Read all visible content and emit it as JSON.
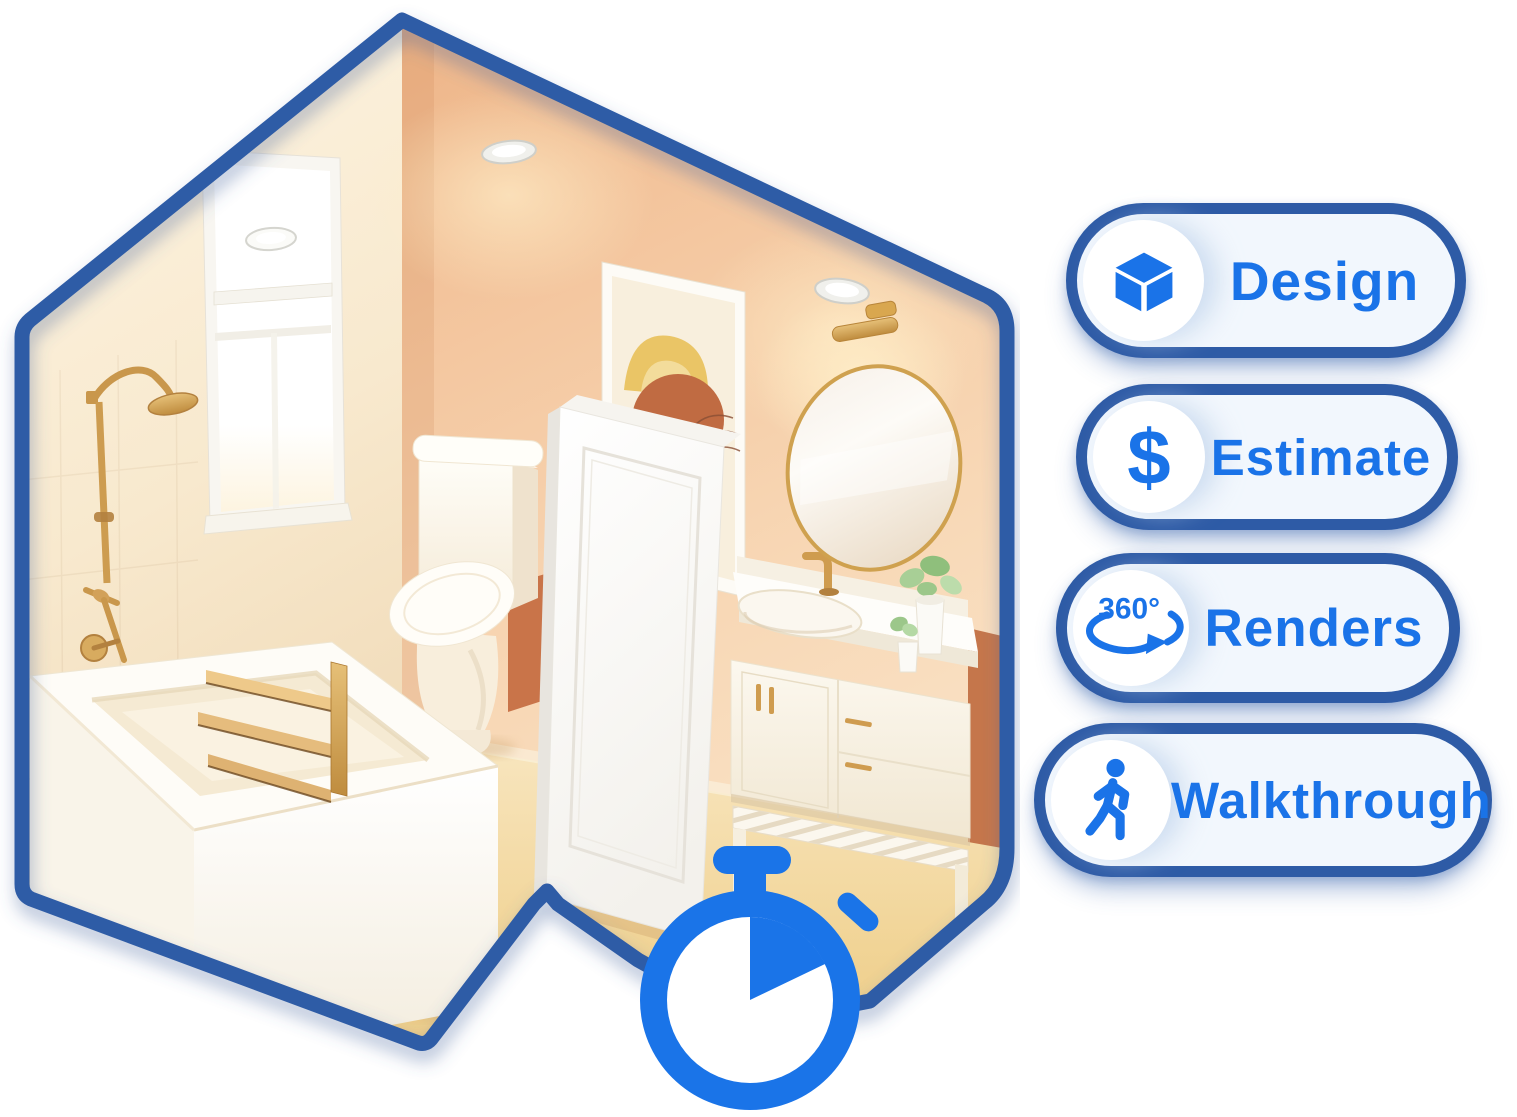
{
  "hero": {
    "feature_buttons": [
      {
        "label": "Design",
        "icon": "cube-3d-icon"
      },
      {
        "label": "Estimate",
        "icon": "dollar-sign-icon",
        "icon_text": "$"
      },
      {
        "label": "Renders",
        "icon": "rotation-360-icon",
        "icon_text": "360°"
      },
      {
        "label": "Walkthrough",
        "icon": "person-walking-icon"
      }
    ],
    "colors": {
      "accent_blue": "#1a73e8",
      "outline_blue": "#2e5ba6",
      "pill_background": "#f2f7fd",
      "icon_circle": "#ffffff"
    }
  },
  "illustration": {
    "name": "isometric-bathroom-render",
    "stopwatch_icon": "stopwatch-icon",
    "objects": [
      "ceiling-lights",
      "window",
      "rain-shower-fixture",
      "bathtub",
      "towel-ladder",
      "toilet",
      "wall-art",
      "interior-door",
      "round-mirror",
      "vanity-sconce-light",
      "vanity-sink-cabinet",
      "potted-plants"
    ],
    "palette": {
      "wall_peach": "#f3c29c",
      "wall_cream": "#faeed9",
      "floor_tan": "#f3d79b",
      "gold_fixture": "#cf9c4f",
      "terracotta": "#c5764b",
      "stopwatch_blue": "#1a74e8"
    }
  }
}
